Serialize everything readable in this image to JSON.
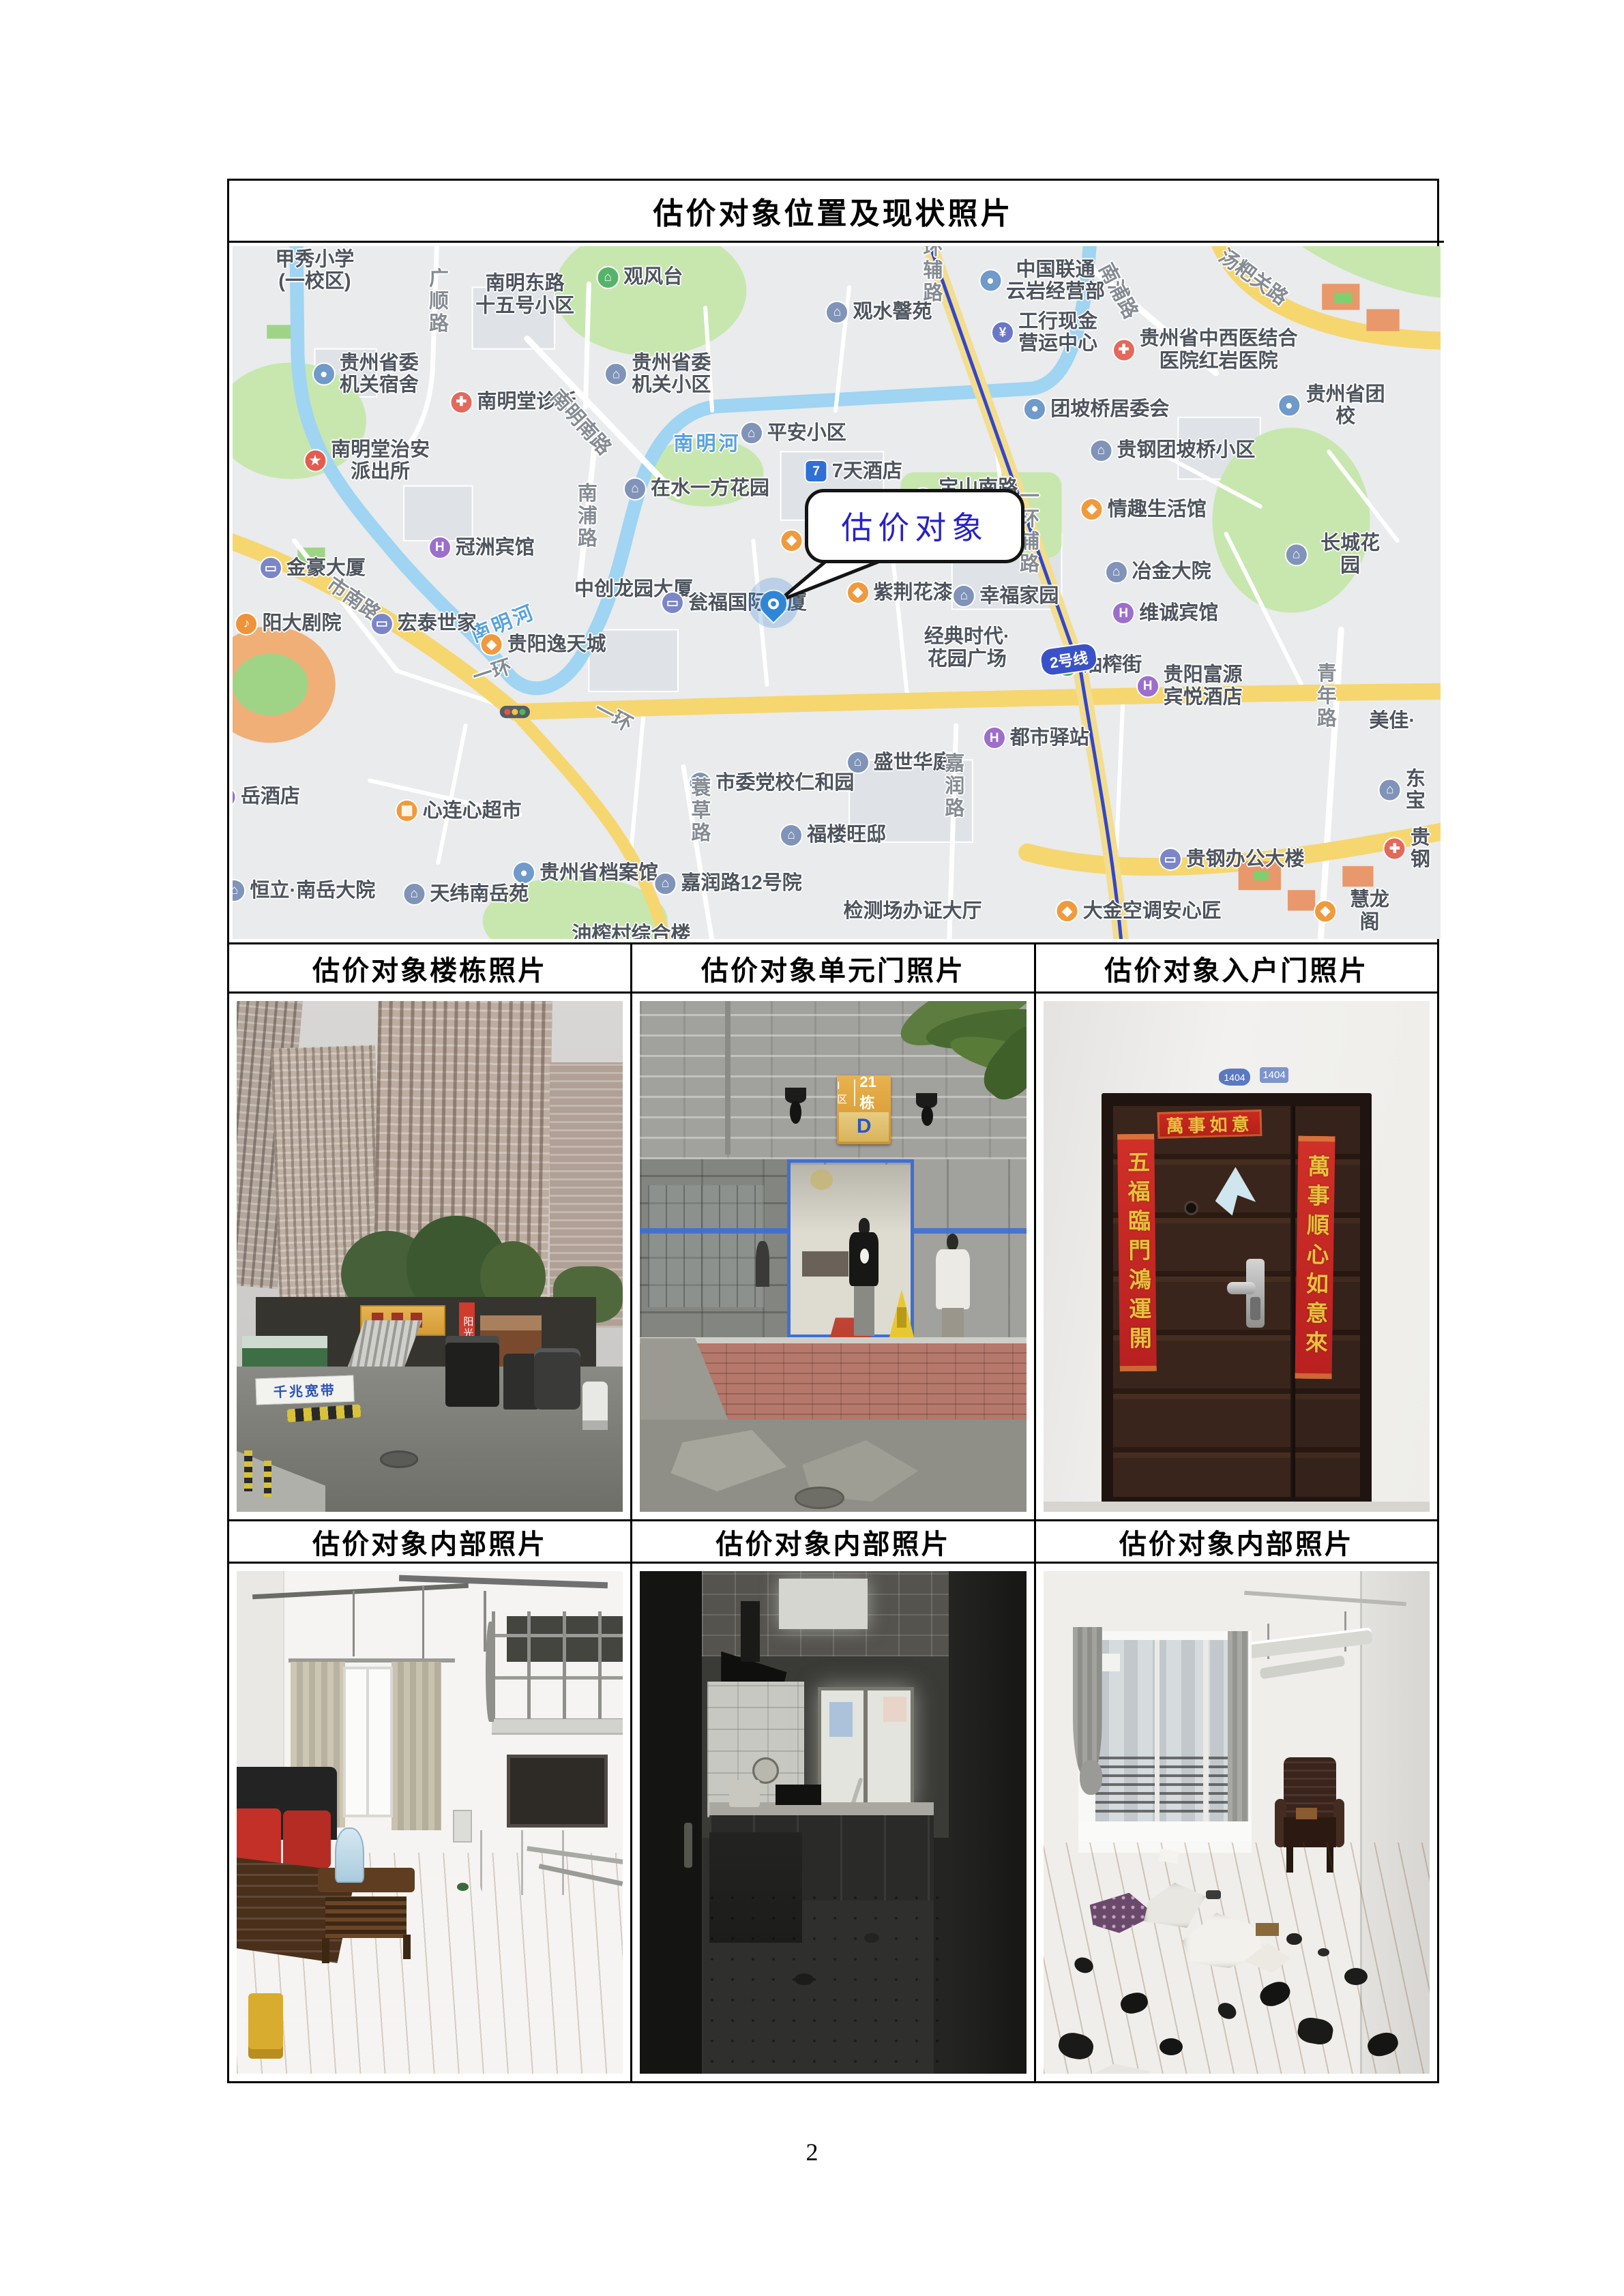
{
  "page": {
    "number": "2"
  },
  "table": {
    "title": "估价对象位置及现状照片",
    "photo_headers_row1": [
      "估价对象楼栋照片",
      "估价对象单元门照片",
      "估价对象入户门照片"
    ],
    "photo_headers_row2": [
      "估价对象内部照片",
      "估价对象内部照片",
      "估价对象内部照片"
    ]
  },
  "map": {
    "callout_text": "估价对象",
    "metro_badge": "2号线",
    "colors": {
      "land": "#e9ebec",
      "road_major": "#f6d66f",
      "water": "#9fd4f2",
      "park": "#c7e7ae",
      "metro_line": "#3347c9",
      "label": "#4e545e"
    },
    "labels": [
      {
        "t": "甲秀小学\n(一校区)",
        "x": 6.8,
        "y": 3.5
      },
      {
        "t": "广顺路",
        "x": 16.9,
        "y": 8,
        "v": 1,
        "road": 1
      },
      {
        "t": "南明东路\n十五号小区",
        "x": 24.2,
        "y": 7
      },
      {
        "t": "观风台",
        "x": 33.7,
        "y": 4.5,
        "icon": "green"
      },
      {
        "t": "观水韾苑",
        "x": 53.5,
        "y": 9.5,
        "icon": "blue"
      },
      {
        "t": "中国联通\n云岩经营部",
        "x": 67,
        "y": 5,
        "icon": "pin"
      },
      {
        "t": "工行现金\n营运中心",
        "x": 67.2,
        "y": 12.5,
        "icon": "bank"
      },
      {
        "t": "贵州省中西医结合\n医院红岩医院",
        "x": 80.5,
        "y": 15,
        "icon": "hosp"
      },
      {
        "t": "贵州省委\n机关宿舍",
        "x": 11,
        "y": 18.5,
        "icon": "pin"
      },
      {
        "t": "贵州省委\n机关小区",
        "x": 35.2,
        "y": 18.5,
        "icon": "blue"
      },
      {
        "t": "南明堂诊所",
        "x": 23.2,
        "y": 22.5,
        "icon": "hosp"
      },
      {
        "t": "南明南路",
        "x": 28.8,
        "y": 25.5,
        "road": 1,
        "r": 48
      },
      {
        "t": "平安小区",
        "x": 46.4,
        "y": 27,
        "icon": "blue"
      },
      {
        "t": "团坡桥居委会",
        "x": 71.5,
        "y": 23.5,
        "icon": "pin"
      },
      {
        "t": "贵钢团坡桥小区",
        "x": 77.8,
        "y": 29.5,
        "icon": "blue"
      },
      {
        "t": "贵州省团校",
        "x": 91,
        "y": 23,
        "icon": "pin"
      },
      {
        "t": "7天酒店",
        "x": 51.4,
        "y": 32.5,
        "icon": "seven"
      },
      {
        "t": "在水一方花园",
        "x": 38.4,
        "y": 35,
        "icon": "blue"
      },
      {
        "t": "宝山南路\n165号院",
        "x": 60.6,
        "y": 36.5,
        "icon": "blue"
      },
      {
        "t": "情趣生活馆",
        "x": 75.4,
        "y": 38,
        "icon": "shop"
      },
      {
        "t": "南明堂治安\n派出所",
        "x": 11.1,
        "y": 31,
        "icon": "police"
      },
      {
        "t": "冠洲宾馆",
        "x": 20.6,
        "y": 43.5,
        "icon": "hotel"
      },
      {
        "t": "南浦路",
        "x": 29.2,
        "y": 39,
        "v": 1,
        "road": 1
      },
      {
        "t": "南浦路",
        "x": 73.3,
        "y": 6.5,
        "road": 1,
        "r": 62
      },
      {
        "t": "环辅路",
        "x": 57.8,
        "y": 3.5,
        "v": 1,
        "road": 1
      },
      {
        "t": "一环辅路",
        "x": 65.8,
        "y": 41,
        "v": 1,
        "road": 1
      },
      {
        "t": "汤粑关路",
        "x": 84.5,
        "y": 4.5,
        "road": 1,
        "r": 36
      },
      {
        "t": "家湘美",
        "x": 48.9,
        "y": 42.5,
        "icon": "shop"
      },
      {
        "t": "紫荆花漆",
        "x": 55.2,
        "y": 50,
        "icon": "shop"
      },
      {
        "t": "幸福家园",
        "x": 64,
        "y": 50.5,
        "icon": "blue"
      },
      {
        "t": "冶金大院",
        "x": 76.6,
        "y": 47,
        "icon": "blue"
      },
      {
        "t": "长城花园",
        "x": 91.4,
        "y": 44.5,
        "icon": "blue"
      },
      {
        "t": "维诚宾馆",
        "x": 77.2,
        "y": 53,
        "icon": "hotel"
      },
      {
        "t": "金豪大厦",
        "x": 6.6,
        "y": 46.5,
        "icon": "bldg"
      },
      {
        "t": "中创龙园大厦",
        "x": 33.2,
        "y": 49.5
      },
      {
        "t": "瓮福国际大厦",
        "x": 41.5,
        "y": 51.5,
        "icon": "bldg"
      },
      {
        "t": "市南路",
        "x": 10,
        "y": 51,
        "road": 1,
        "r": 35
      },
      {
        "t": "南明河",
        "x": 39.3,
        "y": 28.5,
        "river": 1
      },
      {
        "t": "南明河",
        "x": 22.4,
        "y": 54.5,
        "river": 1,
        "r": -22
      },
      {
        "t": "宏泰世家",
        "x": 15.8,
        "y": 54.5,
        "icon": "bldg"
      },
      {
        "t": "阳大剧院",
        "x": 4.6,
        "y": 54.5,
        "icon": "music"
      },
      {
        "t": "贵阳逸天城",
        "x": 25.7,
        "y": 57.5,
        "icon": "shop"
      },
      {
        "t": "经典时代·\n花园广场",
        "x": 60.8,
        "y": 58
      },
      {
        "t": "油榨街",
        "x": 71.7,
        "y": 60.5,
        "icon": "metro"
      },
      {
        "t": "一环",
        "x": 21.5,
        "y": 61.5,
        "road": 1,
        "r": -18
      },
      {
        "t": "一环",
        "x": 31.5,
        "y": 68,
        "road": 1,
        "r": 28
      },
      {
        "t": "都市驿站",
        "x": 66.5,
        "y": 71,
        "icon": "hotel"
      },
      {
        "t": "贵阳富源\n宾悦酒店",
        "x": 79.2,
        "y": 63.5,
        "icon": "hotel"
      },
      {
        "t": "青年路",
        "x": 90.4,
        "y": 65,
        "v": 1,
        "road": 1
      },
      {
        "t": "美佳·",
        "x": 96,
        "y": 68.5
      },
      {
        "t": "东宝",
        "x": 96.8,
        "y": 78.5,
        "icon": "blue"
      },
      {
        "t": "盛世华庭",
        "x": 55.2,
        "y": 74.5,
        "icon": "blue"
      },
      {
        "t": "嘉润路",
        "x": 59.6,
        "y": 78,
        "v": 1,
        "road": 1
      },
      {
        "t": "心连心超市",
        "x": 18.7,
        "y": 81.5,
        "icon": "cart"
      },
      {
        "t": "岳酒店",
        "x": 2,
        "y": 79.5,
        "icon": "hotel"
      },
      {
        "t": "市委党校仁和园",
        "x": 44.6,
        "y": 77.5,
        "icon": "blue"
      },
      {
        "t": "蓑草路",
        "x": 38.6,
        "y": 81.5,
        "v": 1,
        "road": 1
      },
      {
        "t": "福楼旺邸",
        "x": 49.7,
        "y": 85,
        "icon": "blue"
      },
      {
        "t": "贵州省档案馆",
        "x": 29.2,
        "y": 90.5,
        "icon": "pin"
      },
      {
        "t": "恒立·南岳大院",
        "x": 5.5,
        "y": 93,
        "icon": "blue"
      },
      {
        "t": "天纬南岳苑",
        "x": 19.3,
        "y": 93.5,
        "icon": "blue"
      },
      {
        "t": "嘉润路12号院",
        "x": 41,
        "y": 92,
        "icon": "blue"
      },
      {
        "t": "检测场办证大厅",
        "x": 56.3,
        "y": 96
      },
      {
        "t": "大金空调安心匠",
        "x": 75,
        "y": 96,
        "icon": "shop"
      },
      {
        "t": "贵钢办公大楼",
        "x": 82.7,
        "y": 88.5,
        "icon": "bldg"
      },
      {
        "t": "慧龙阁",
        "x": 93,
        "y": 96,
        "icon": "shop"
      },
      {
        "t": "贵钢",
        "x": 97.2,
        "y": 87,
        "icon": "hosp"
      },
      {
        "t": "油榨村综合楼",
        "x": 33,
        "y": 99.3
      }
    ]
  },
  "photos": {
    "building": {
      "banner": "千兆宽带",
      "vertical_sign": "阳光100"
    },
    "unit_door": {
      "sign_zone": "Ⅰ区",
      "sign_number": "21栋",
      "sign_elevator": "D"
    },
    "entry_door": {
      "plate": "1404",
      "banner": "萬事如意",
      "couplet_left": "五福臨門鴻運開",
      "couplet_right": "萬事順心如意來"
    }
  }
}
